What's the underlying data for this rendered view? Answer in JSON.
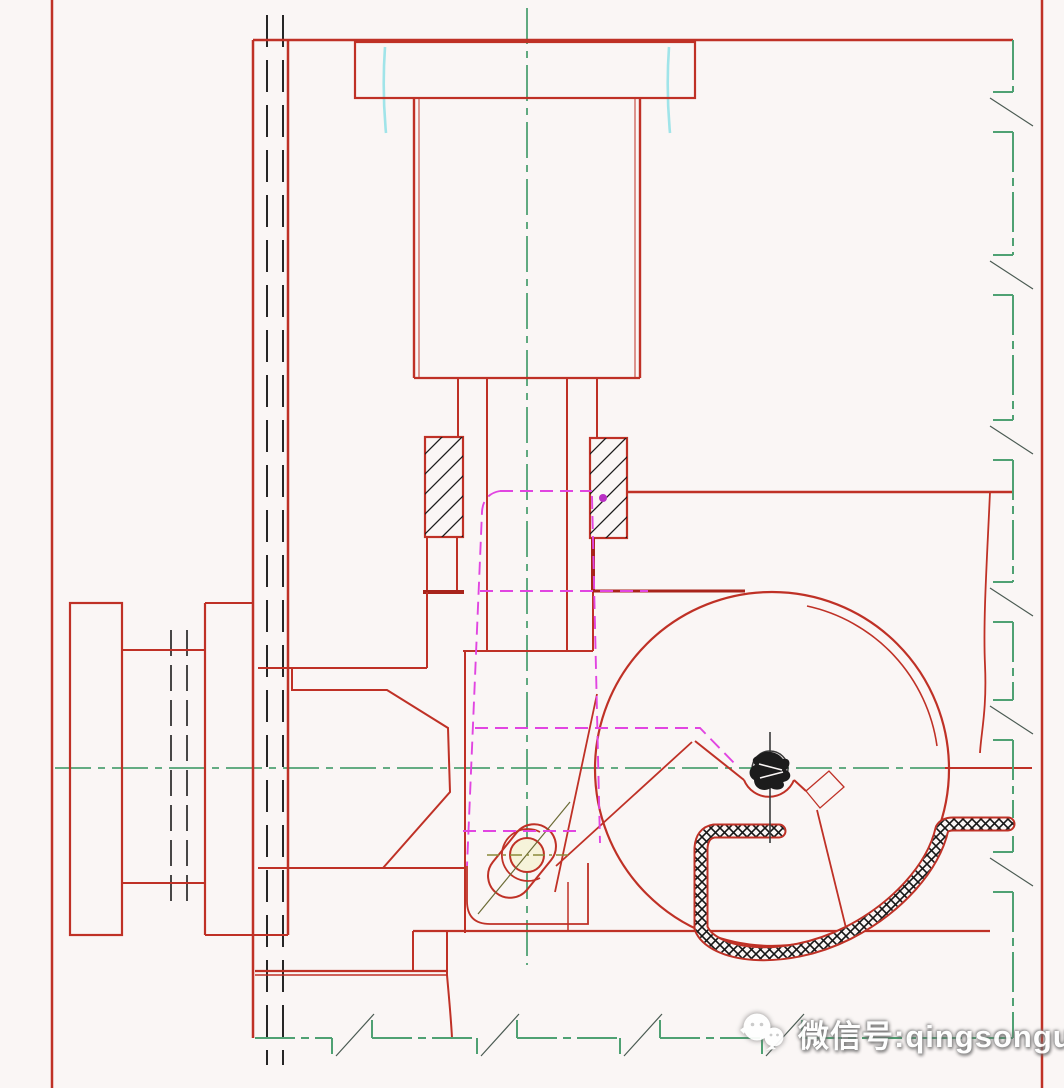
{
  "document": {
    "type": "CAD engineering drawing - mechanical assembly section view",
    "canvas": {
      "width_px": 1064,
      "height_px": 1088
    }
  },
  "watermark": {
    "icon": "wechat-icon",
    "text": "微信号:qingsongug"
  },
  "colors": {
    "background": "#faf6f5",
    "red": "#bf3126",
    "red_bold": "#a8241b",
    "green": "#4fa173",
    "cyan": "#8fe0e6",
    "magenta": "#e145e1",
    "magenta_dot": "#b92fc4",
    "black": "#1c1c1c",
    "screw_dark": "#3a3a3a",
    "olive": "#8a8a3a",
    "break_gray": "#4a5a52",
    "slot_fill": "#f6f3da",
    "watermark_text": "#ffffff"
  }
}
